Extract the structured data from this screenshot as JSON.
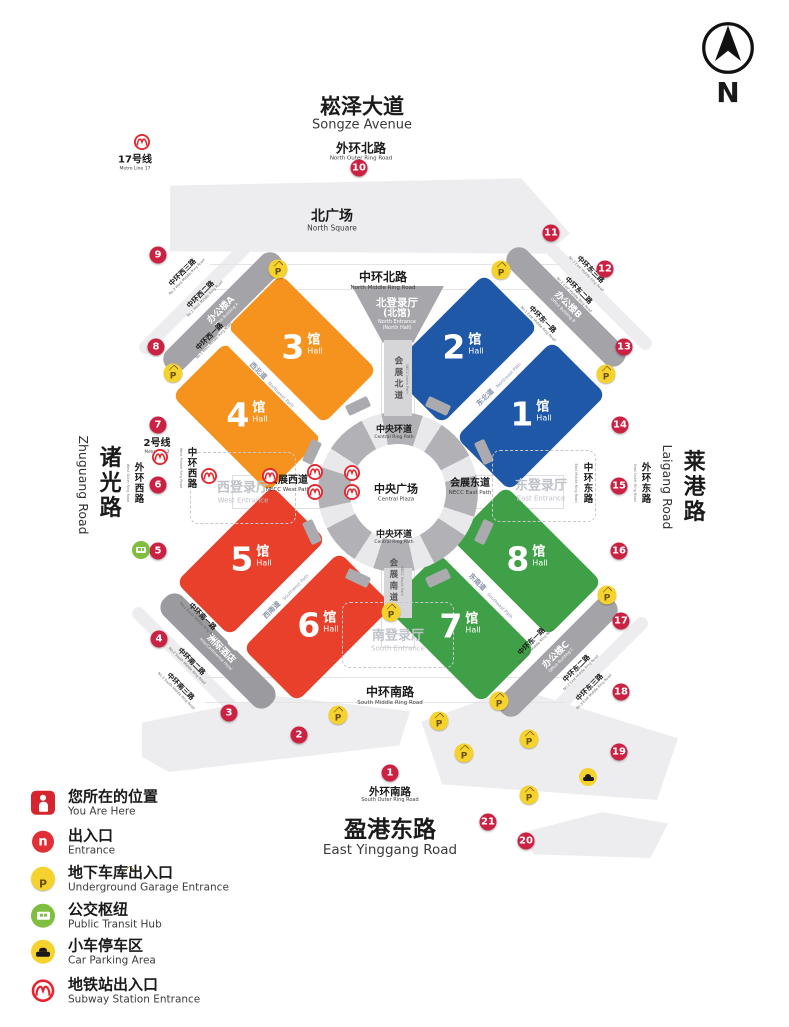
{
  "compass": {
    "letter": "N"
  },
  "icons": {
    "parking_letter": "P",
    "entrance_letter": "n"
  },
  "roads": {
    "songze": {
      "cn": "崧泽大道",
      "en": "Songze Avenue"
    },
    "north_outer": {
      "cn": "外环北路",
      "en": "North Outer Ring Road"
    },
    "north_middle": {
      "cn": "中环北路",
      "en": "North Middle Ring Road"
    },
    "south_middle": {
      "cn": "中环南路",
      "en": "South Middle Ring Road"
    },
    "south_outer": {
      "cn": "外环南路",
      "en": "South Outer Ring Road"
    },
    "yinggang": {
      "cn": "盈港东路",
      "en": "East Yinggang Road"
    },
    "zhuguang": {
      "cn": "诸光路",
      "en": "Zhuguang Road"
    },
    "laigang": {
      "cn": "莱港路",
      "en": "Laigang Road"
    },
    "west_outer": {
      "cn": "外环西路",
      "en": "West Outer Ring Road"
    },
    "west_middle": {
      "cn": "中环西路",
      "en": "West Middle Ring Road"
    },
    "east_middle": {
      "cn": "中环东路",
      "en": "East Middle Ring Road"
    },
    "east_outer": {
      "cn": "外环东路",
      "en": "East Outer Ring Road"
    }
  },
  "corner_roads": {
    "nw3": {
      "cn": "中环西三路",
      "en": "No.3 West Middle Ring Road"
    },
    "nw2": {
      "cn": "中环西二路",
      "en": "No.2 West Middle Ring Road"
    },
    "nw1": {
      "cn": "中环西一路",
      "en": "No.1 West Middle Ring Road"
    },
    "ne3": {
      "cn": "中环东三路",
      "en": "No.3 East Middle Ring Road"
    },
    "ne2": {
      "cn": "中环东二路",
      "en": "No.2 East Middle Ring Road"
    },
    "ne1": {
      "cn": "中环东一路",
      "en": "No.1 East Middle Ring Road"
    },
    "sw1": {
      "cn": "中环南一路",
      "en": "No.1 South Middle Ring Road"
    },
    "sw2": {
      "cn": "中环南二路",
      "en": "No.2 South Middle Ring Road"
    },
    "sw3": {
      "cn": "中环南三路",
      "en": "No.3 South Middle Ring Road"
    },
    "se1": {
      "cn": "中环东一路",
      "en": "No.1 East Middle Ring Road"
    },
    "se2": {
      "cn": "中环东二路",
      "en": "No.2 East Middle Ring Road"
    },
    "se3": {
      "cn": "中环东三路",
      "en": "No.3 East Middle Ring Road"
    }
  },
  "areas": {
    "north_square": {
      "cn": "北广场",
      "en": "North Square"
    },
    "central_plaza": {
      "cn": "中央广场",
      "en": "Central Plaza"
    },
    "ring_path": {
      "cn": "中央环道",
      "en": "Central Ring Path"
    },
    "necc_west": {
      "cn": "会展西道",
      "en": "NECC West Path"
    },
    "necc_east": {
      "cn": "会展东道",
      "en": "NECC East Path"
    },
    "necc_north": {
      "cn": "会展北道",
      "en": "NECC North Path"
    },
    "necc_south": {
      "cn": "会展南道",
      "en": "NECC South Path"
    }
  },
  "entrances": {
    "north": {
      "cn": "北登录厅",
      "cn2": "(北馆)",
      "en": "North Entrance",
      "en2": "(North Hall)"
    },
    "west": {
      "cn": "西登录厅",
      "en": "West Entrance"
    },
    "east": {
      "cn": "东登录厅",
      "en": "East Entrance"
    },
    "south": {
      "cn": "南登录厅",
      "en": "South Entrance"
    }
  },
  "halls": [
    {
      "num": "1",
      "cn": "馆",
      "en": "Hall"
    },
    {
      "num": "2",
      "cn": "馆",
      "en": "Hall"
    },
    {
      "num": "3",
      "cn": "馆",
      "en": "Hall"
    },
    {
      "num": "4",
      "cn": "馆",
      "en": "Hall"
    },
    {
      "num": "5",
      "cn": "馆",
      "en": "Hall"
    },
    {
      "num": "6",
      "cn": "馆",
      "en": "Hall"
    },
    {
      "num": "7",
      "cn": "馆",
      "en": "Hall"
    },
    {
      "num": "8",
      "cn": "馆",
      "en": "Hall"
    }
  ],
  "pair_paths": {
    "nw": {
      "cn": "西北道",
      "en": "Northwest Path"
    },
    "ne": {
      "cn": "东北道",
      "en": "Northeast Path"
    },
    "sw": {
      "cn": "西南道",
      "en": "Southwest Path"
    },
    "se": {
      "cn": "东南道",
      "en": "Southeast Path"
    }
  },
  "buildings": {
    "a": {
      "cn": "办公楼A",
      "en": "Office Building A"
    },
    "b": {
      "cn": "办公楼B",
      "en": "Office Building B"
    },
    "c": {
      "cn": "办公楼C",
      "en": "Office Building C"
    },
    "hotel": {
      "cn": "洲际酒店",
      "en": "InterContinental Hotel"
    }
  },
  "metro_lines": {
    "line17": {
      "cn": "17号线",
      "en": "Metro Line 17"
    },
    "line2": {
      "cn": "2号线",
      "en": "Metro Line 2"
    }
  },
  "markers": [
    "1",
    "2",
    "3",
    "4",
    "5",
    "6",
    "7",
    "8",
    "9",
    "10",
    "11",
    "12",
    "13",
    "14",
    "15",
    "16",
    "17",
    "18",
    "19",
    "20",
    "21"
  ],
  "legend": [
    {
      "cn": "您所在的位置",
      "en": "You Are Here"
    },
    {
      "cn": "出入口",
      "en": "Entrance"
    },
    {
      "cn": "地下车库出入口",
      "en": "Underground Garage Entrance"
    },
    {
      "cn": "公交枢纽",
      "en": "Public Transit Hub"
    },
    {
      "cn": "小车停车区",
      "en": "Car Parking Area"
    },
    {
      "cn": "地铁站出入口",
      "en": "Subway Station Entrance"
    }
  ],
  "colors": {
    "hall_orange": "#f6921e",
    "hall_blue": "#2058a8",
    "hall_red": "#e8402a",
    "hall_green": "#3fa047",
    "marker_red": "#cb2143",
    "parking_yellow": "#f6d22e",
    "bus_green": "#7fbe3f",
    "metro_red": "#e6242e"
  }
}
